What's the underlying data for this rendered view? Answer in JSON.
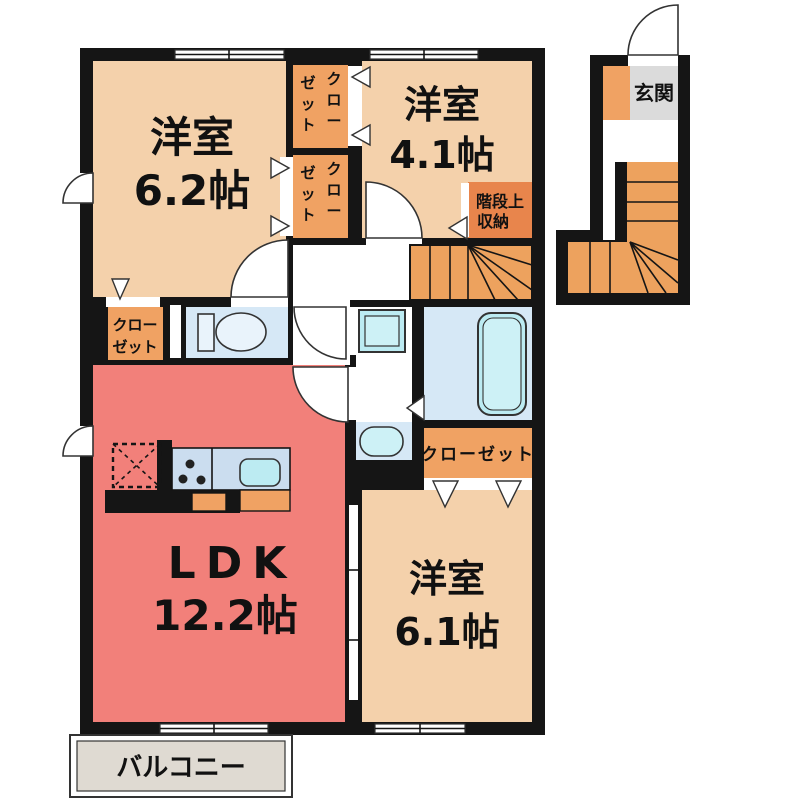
{
  "plan": {
    "rooms": {
      "bedroom_nw": {
        "name": "洋室",
        "size": "6.2帖"
      },
      "bedroom_ne": {
        "name": "洋室",
        "size": "4.1帖"
      },
      "ldk": {
        "name": "LDK",
        "size": "12.2帖"
      },
      "bedroom_se": {
        "name": "洋室",
        "size": "6.1帖"
      },
      "balcony": {
        "label": "バルコニー"
      },
      "entrance": {
        "label": "玄関"
      },
      "stair_storage": {
        "line1": "階段上",
        "line2": "収納"
      }
    },
    "closets": {
      "upper_north": {
        "label": "クローゼット",
        "col1": "クロー",
        "col2": "ゼット"
      },
      "upper_south": {
        "label": "クローゼット",
        "col1": "クロー",
        "col2": "ゼット"
      },
      "west": {
        "label": "クローゼット",
        "line1": "クロー",
        "line2": "ゼット"
      },
      "east": {
        "label": "クローゼット"
      }
    },
    "colors": {
      "wall": "#151515",
      "room_peach": "#F4D1AB",
      "closet_orange": "#F0A263",
      "storage_dark_orange": "#E8854C",
      "stairs_orange": "#EDA25E",
      "ldk_red": "#F2807A",
      "wet_area_blue": "#D6E8F6",
      "fixture_cyan": "#BCEBF2",
      "kitchen_counter": "#CBDDEF",
      "entrance_gray": "#DBDBDB",
      "balcony_gray": "#DFDAD2"
    }
  }
}
